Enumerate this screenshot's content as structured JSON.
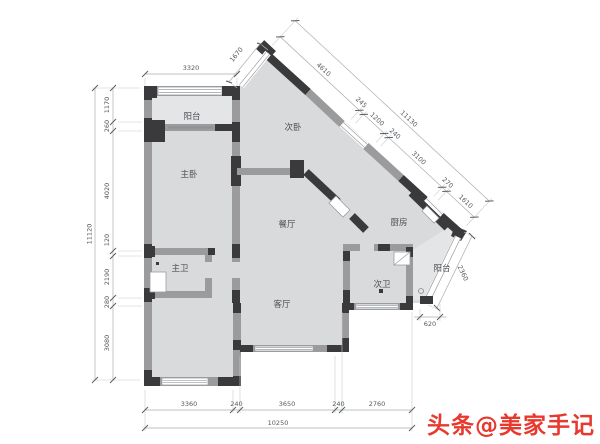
{
  "plan": {
    "rooms": [
      {
        "key": "balcony-top",
        "label": "阳台"
      },
      {
        "key": "master-bedroom",
        "label": "主卧"
      },
      {
        "key": "second-bedroom",
        "label": "次卧"
      },
      {
        "key": "dining-room",
        "label": "餐厅"
      },
      {
        "key": "kitchen",
        "label": "厨房"
      },
      {
        "key": "master-bath",
        "label": "主卫"
      },
      {
        "key": "second-bath",
        "label": "次卫"
      },
      {
        "key": "living-room",
        "label": "客厅"
      },
      {
        "key": "balcony-bottom",
        "label": "阳台"
      }
    ],
    "dims": {
      "top_width": "3320",
      "entry": "1670",
      "left": [
        "1170",
        "260",
        "4020",
        "120",
        "2190",
        "280",
        "3080"
      ],
      "left_total": "11120",
      "ne": [
        "4610",
        "245",
        "1200",
        "240",
        "3100",
        "270",
        "1610"
      ],
      "ne_total": "11130",
      "se_balcony": "2360",
      "step": "620",
      "bottom": [
        "3360",
        "240",
        "3650",
        "240",
        "2760"
      ],
      "bottom_total": "10250"
    }
  },
  "watermark": {
    "text": "头条@美家手记"
  },
  "colors": {
    "wall_dark": "#3a3a3c",
    "wall_gray": "#9b9b9d",
    "floor": "#d9dadc",
    "floor_light": "#e4e5e7",
    "watermark_red": "#e8392e"
  }
}
